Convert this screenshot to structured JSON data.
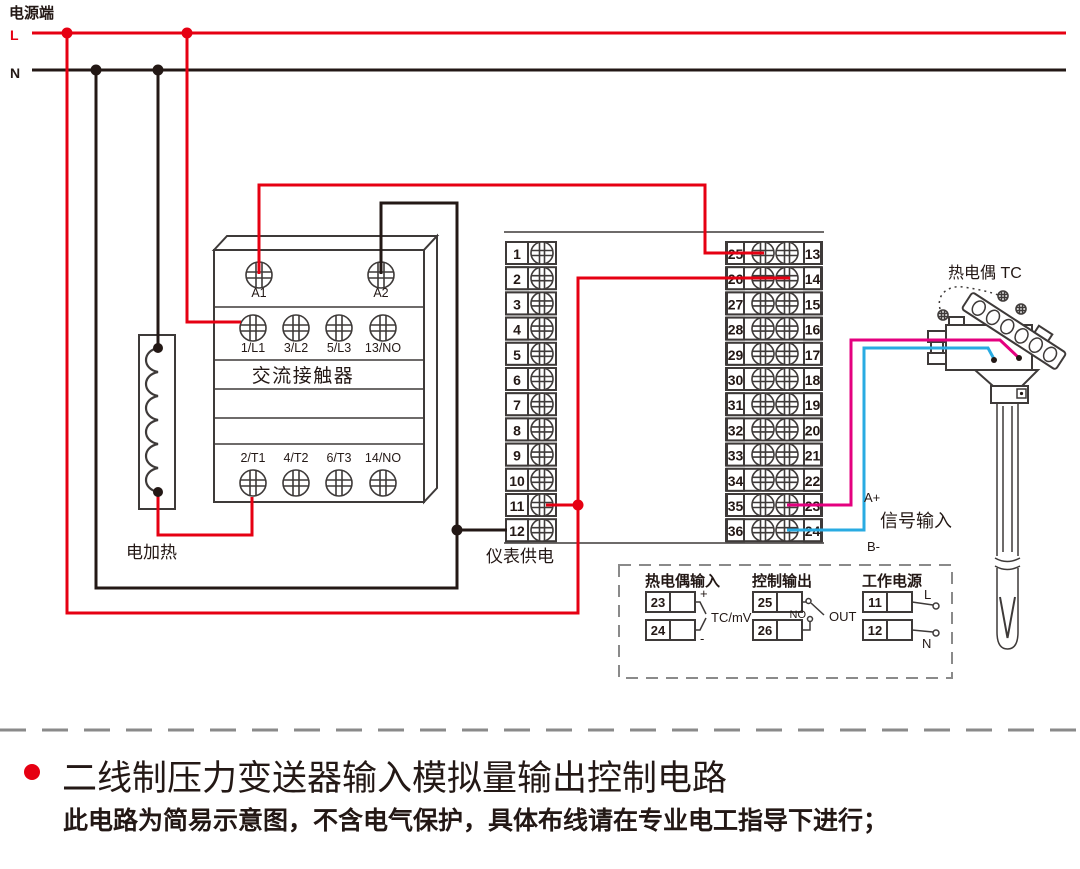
{
  "colors": {
    "wire_live_red": "#e60012",
    "wire_neutral_black": "#231815",
    "wire_signal_pink": "#e4007f",
    "wire_signal_blue": "#29abe2",
    "component_stroke": "#3e3a39",
    "divider_gray": "#8a8a8a"
  },
  "power": {
    "title": "电源端",
    "l": "L",
    "n": "N"
  },
  "contactor": {
    "title": "交流接触器",
    "coil": [
      "A1",
      "A2"
    ],
    "top": [
      "1/L1",
      "3/L2",
      "5/L3",
      "13/NO"
    ],
    "bottom": [
      "2/T1",
      "4/T2",
      "6/T3",
      "14/NO"
    ]
  },
  "heater": {
    "label": "电加热"
  },
  "meter": {
    "supply_label": "仪表供电",
    "left_numbers": [
      "1",
      "2",
      "3",
      "4",
      "5",
      "6",
      "7",
      "8",
      "9",
      "10",
      "11",
      "12"
    ],
    "right_left_numbers": [
      "25",
      "26",
      "27",
      "28",
      "29",
      "30",
      "31",
      "32",
      "33",
      "34",
      "35",
      "36"
    ],
    "right_right_numbers": [
      "13",
      "14",
      "15",
      "16",
      "17",
      "18",
      "19",
      "20",
      "21",
      "22",
      "23",
      "24"
    ]
  },
  "signal": {
    "a_plus": "A+",
    "b_minus": "B-",
    "label": "信号输入"
  },
  "thermocouple": {
    "label": "热电偶 TC"
  },
  "legend": {
    "tc_input": {
      "title": "热电偶输入",
      "t1": "23",
      "t2": "24",
      "plus": "+",
      "minus": "-",
      "unit": "TC/mV"
    },
    "control_output": {
      "title": "控制输出",
      "t1": "25",
      "t2": "26",
      "no": "NO",
      "out": "OUT"
    },
    "working_power": {
      "title": "工作电源",
      "t1": "11",
      "t2": "12",
      "l": "L",
      "n": "N"
    }
  },
  "caption": {
    "title": "二线制压力变送器输入模拟量输出控制电路",
    "subtitle": "此电路为简易示意图，不含电气保护，具体布线请在专业电工指导下进行；"
  }
}
